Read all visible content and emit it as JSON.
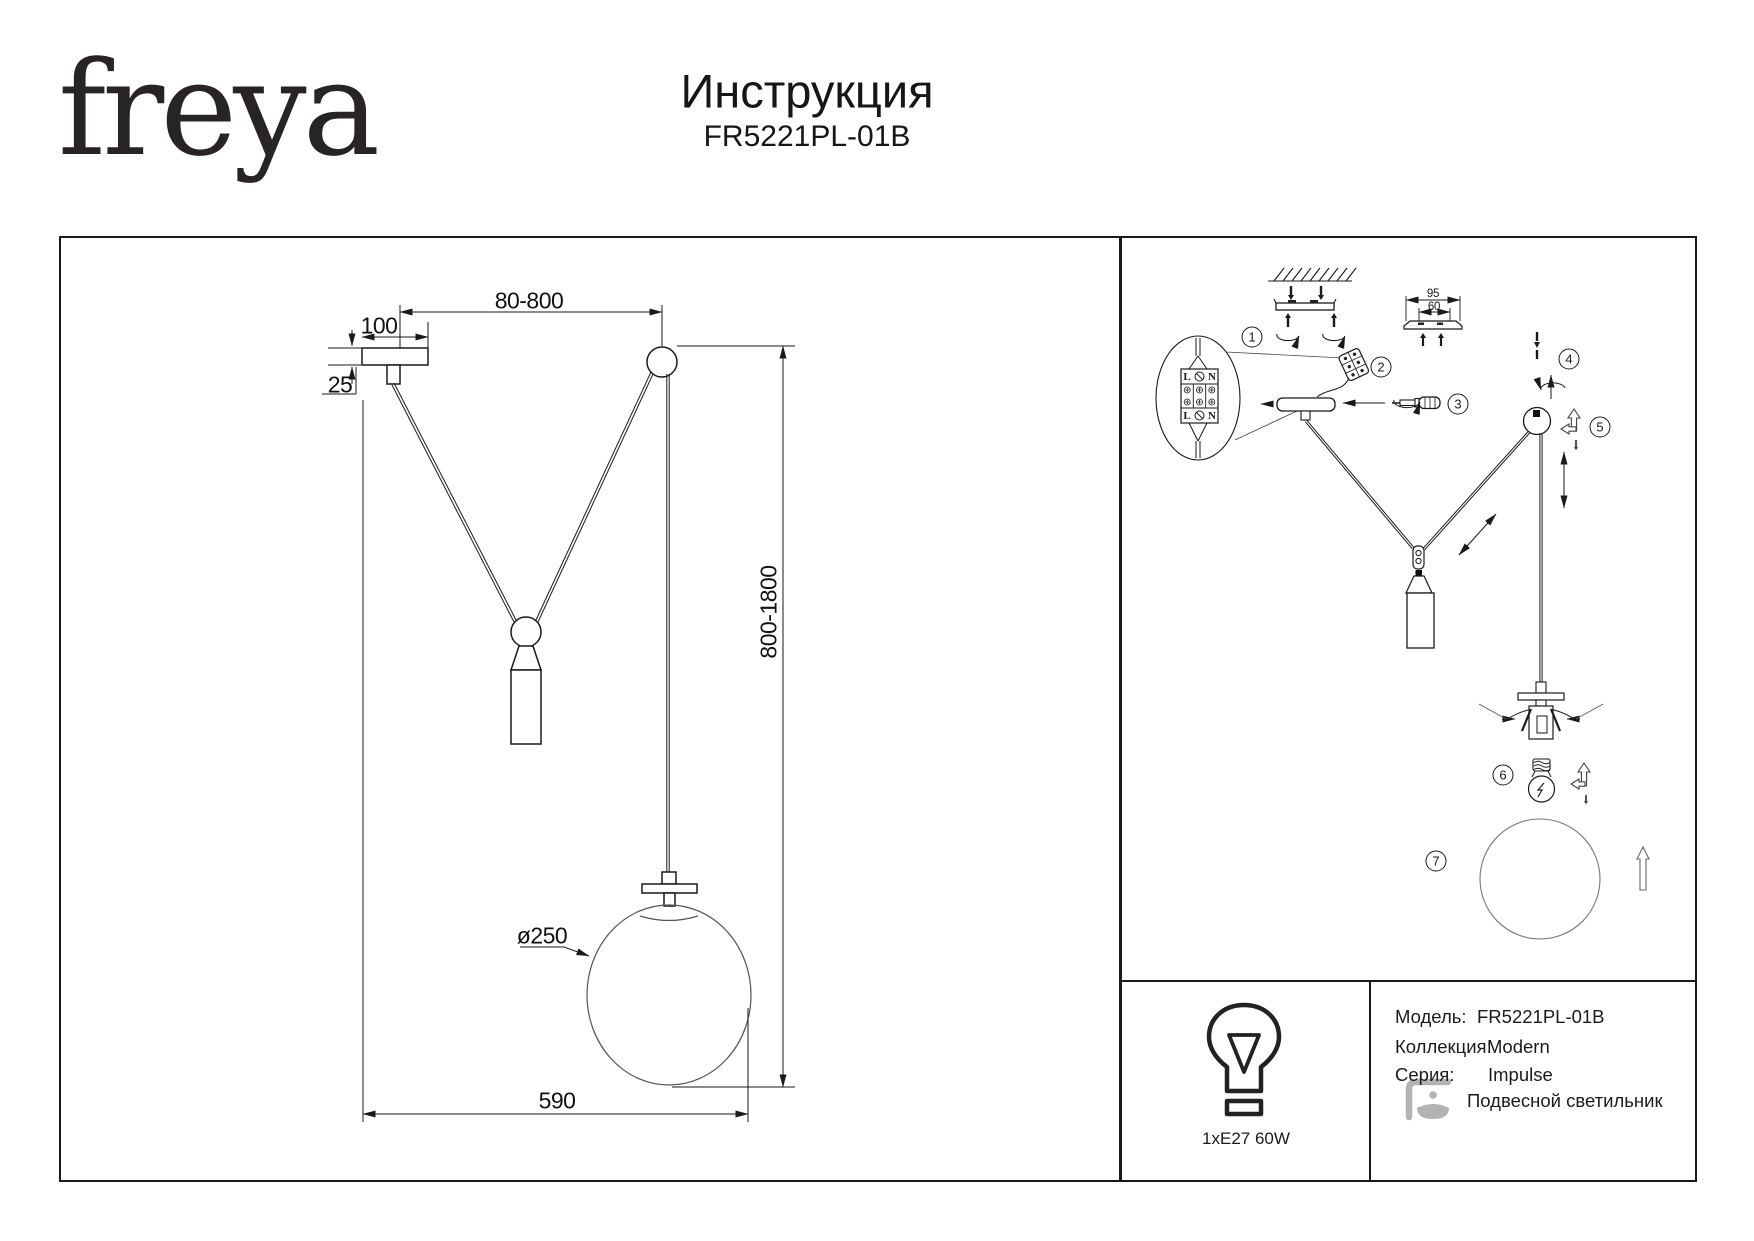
{
  "header": {
    "logo": "freya",
    "title": "Инструкция",
    "model": "FR5221PL-01B"
  },
  "drawing": {
    "dim_top_offset": "80-800",
    "dim_canopy_width": "100",
    "dim_canopy_height": "25",
    "dim_height_range": "800-1800",
    "dim_shade_diameter": "ø250",
    "dim_bottom_span": "590"
  },
  "assembly": {
    "steps": [
      "1",
      "2",
      "3",
      "4",
      "5",
      "6",
      "7"
    ],
    "bracket_dim_outer": "95",
    "bracket_dim_inner": "60",
    "terminal_live": "L",
    "terminal_neutral": "N"
  },
  "spec": {
    "bulb": "1xE27 60W",
    "model_label": "Модель:",
    "model_value": "FR5221PL-01B",
    "collection_label": "Коллекция:",
    "collection_value": "Modern",
    "series_label": "Серия:",
    "series_value": "Impulse",
    "type_value": "Подвесной светильник"
  },
  "colors": {
    "ink": "#1a1a1a",
    "muted_icon": "#b3b3b3"
  }
}
